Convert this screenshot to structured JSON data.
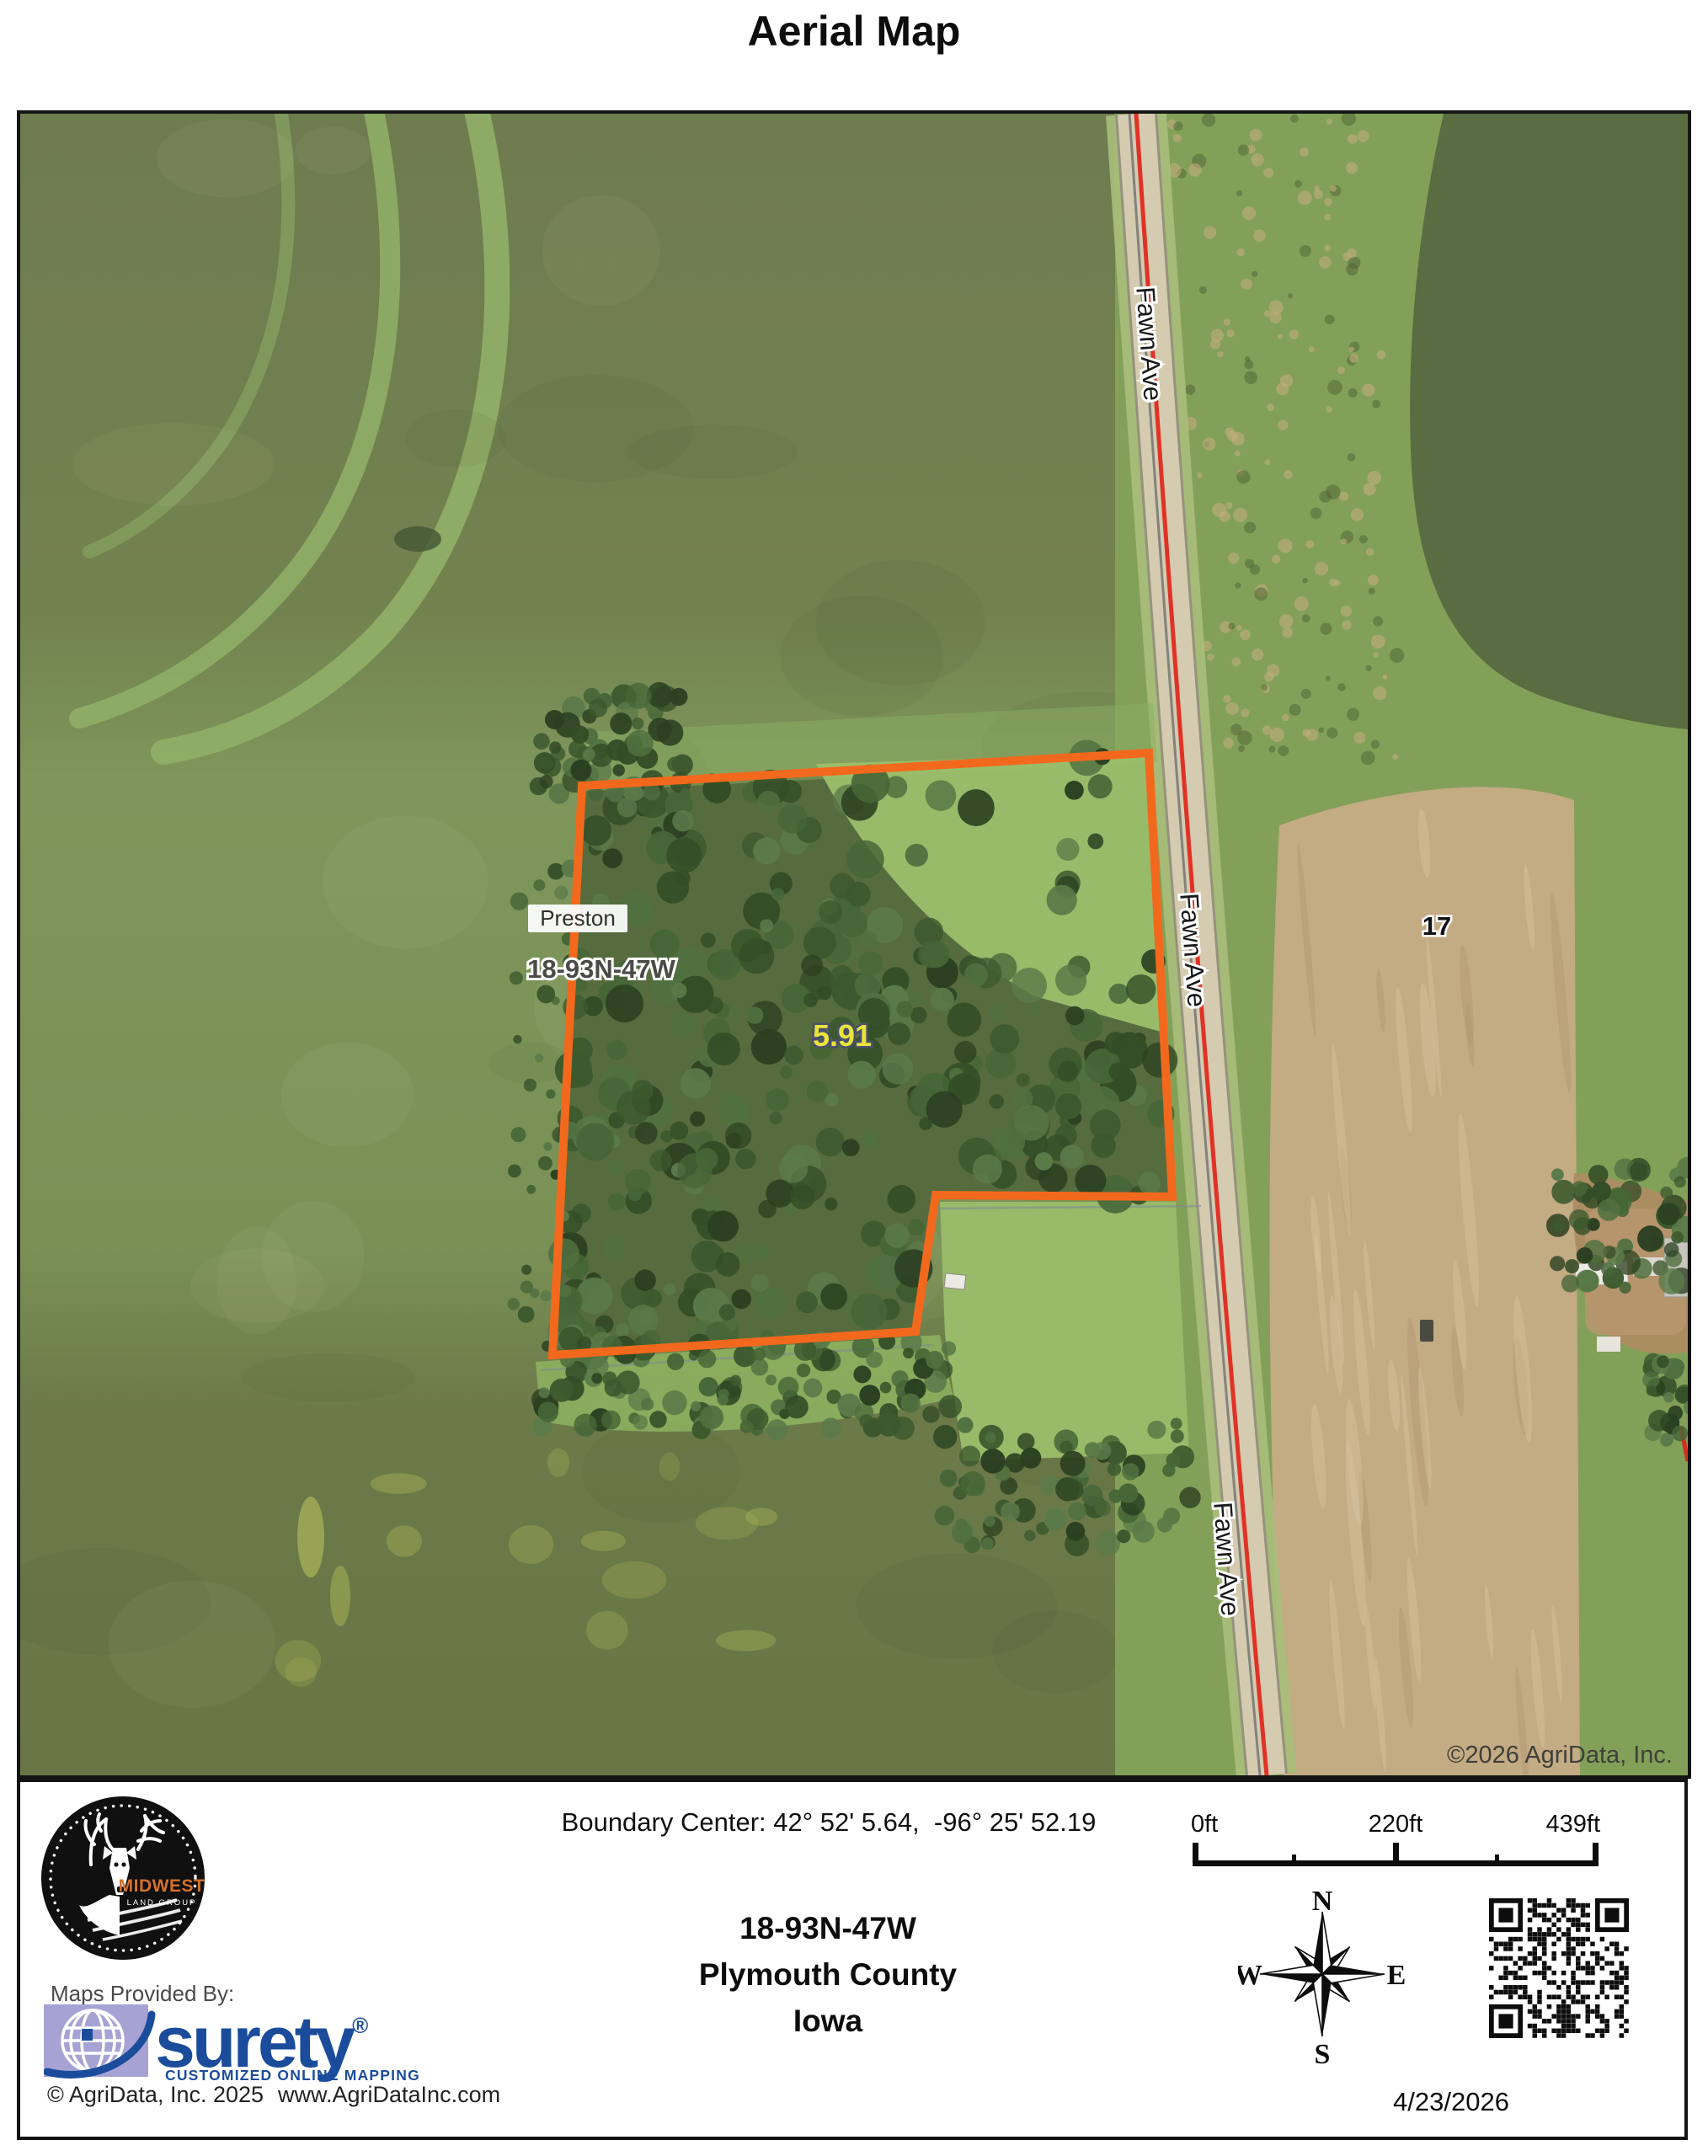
{
  "page": {
    "title": "Aerial Map"
  },
  "map": {
    "copyright": "©2026 AgriData, Inc.",
    "labels": {
      "place": "Preston",
      "township": "18-93N-47W",
      "acreage": "5.91",
      "section": "17",
      "road": "Fawn Ave"
    },
    "boundary": {
      "color": "#F2691D",
      "points": [
        [
          667,
          798
        ],
        [
          1340,
          759
        ],
        [
          1368,
          1286
        ],
        [
          1087,
          1284
        ],
        [
          1063,
          1446
        ],
        [
          632,
          1474
        ]
      ]
    }
  },
  "footer": {
    "boundary_center": "Boundary Center: 42° 52' 5.64,  -96° 25' 52.19",
    "township": "18-93N-47W",
    "county": "Plymouth County",
    "state": "Iowa",
    "provider": {
      "label": "Maps Provided By:",
      "brand": "surety",
      "registered": "®",
      "tagline": "CUSTOMIZED ONLINE MAPPING",
      "brand_color": "#1B4C9C"
    },
    "logo": {
      "name": "MIDWEST",
      "subname": "LAND GROUP"
    },
    "copyright": "© AgriData, Inc. 2025",
    "website": "www.AgriDataInc.com",
    "scale_bar": {
      "labels": [
        "0ft",
        "220ft",
        "439ft"
      ]
    },
    "compass": {
      "n": "N",
      "e": "E",
      "s": "S",
      "w": "W"
    },
    "date": "4/23/2026"
  }
}
